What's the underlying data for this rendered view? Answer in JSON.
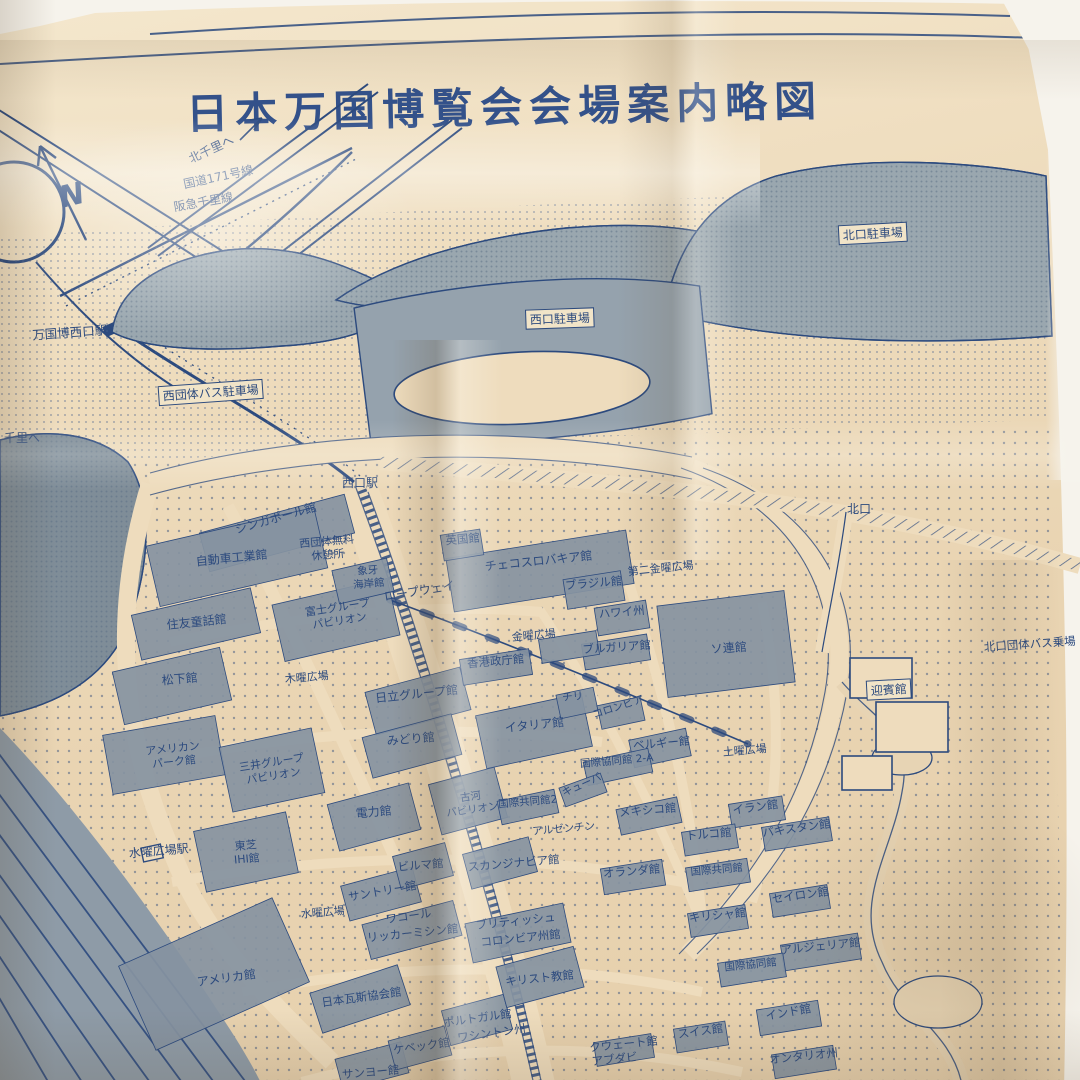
{
  "photo": {
    "title": "日本万国博覧会会場案内略図",
    "compass_label": "N"
  },
  "map": {
    "ink": "#2c4a7e",
    "fabric": "#eedcbd",
    "block": "#8593a1",
    "hill": "#9aa7af",
    "labels": [
      {
        "text": "北千里へ",
        "x": 213,
        "y": 153,
        "rot": -25,
        "size": 12
      },
      {
        "text": "国道171号線",
        "x": 219,
        "y": 181,
        "rot": -12,
        "size": 12
      },
      {
        "text": "阪急千里線",
        "x": 204,
        "y": 206,
        "rot": -10,
        "size": 12
      },
      {
        "text": "北口駐車場",
        "x": 873,
        "y": 238,
        "rot": -3,
        "size": 12,
        "boxed": true
      },
      {
        "text": "万国博西口駅",
        "x": 70,
        "y": 337,
        "rot": -4,
        "size": 12.5
      },
      {
        "text": "西口駐車場",
        "x": 560,
        "y": 323,
        "rot": -2,
        "size": 12,
        "boxed": true
      },
      {
        "text": "西団体バス駐車場",
        "x": 211,
        "y": 397,
        "rot": -4,
        "size": 12,
        "boxed": true
      },
      {
        "text": "千里へ",
        "x": 22,
        "y": 442,
        "rot": 0,
        "size": 12
      },
      {
        "text": "西口駅",
        "x": 360,
        "y": 487,
        "rot": 0,
        "size": 12
      },
      {
        "text": "北口",
        "x": 859,
        "y": 513,
        "rot": 0,
        "size": 12
      },
      {
        "text": "シンガポール館",
        "x": 277,
        "y": 522,
        "rot": -16,
        "size": 12
      },
      {
        "lines": [
          "西団体無料",
          "休憩所"
        ],
        "x": 327,
        "y": 545,
        "rot": -5,
        "size": 11
      },
      {
        "text": "自動車工業館",
        "x": 232,
        "y": 562,
        "rot": -6,
        "size": 12
      },
      {
        "text": "英国館",
        "x": 463,
        "y": 543,
        "rot": -5,
        "size": 11.5
      },
      {
        "text": "チェコスロバキア館",
        "x": 539,
        "y": 565,
        "rot": -6,
        "size": 12
      },
      {
        "text": "第二金曜広場",
        "x": 661,
        "y": 572,
        "rot": -6,
        "size": 11
      },
      {
        "text": "ブラジル館",
        "x": 594,
        "y": 587,
        "rot": -5,
        "size": 11.5
      },
      {
        "lines": [
          "象牙",
          "海岸館"
        ],
        "x": 368,
        "y": 574,
        "rot": -5,
        "size": 10.5
      },
      {
        "text": "ロープウェイ",
        "x": 420,
        "y": 595,
        "rot": -9,
        "size": 12
      },
      {
        "text": "ハワイ州",
        "x": 622,
        "y": 616,
        "rot": -5,
        "size": 11.5
      },
      {
        "lines": [
          "富士グループ",
          "パビリオン"
        ],
        "x": 338,
        "y": 611,
        "rot": -9,
        "size": 11
      },
      {
        "text": "住友童話館",
        "x": 197,
        "y": 626,
        "rot": -6,
        "size": 12
      },
      {
        "text": "金曜広場",
        "x": 534,
        "y": 639,
        "rot": -5,
        "size": 11
      },
      {
        "text": "ブルガリア館",
        "x": 617,
        "y": 651,
        "rot": -4,
        "size": 11.5
      },
      {
        "text": "ソ連館",
        "x": 729,
        "y": 652,
        "rot": -4,
        "size": 12
      },
      {
        "text": "北口団体バス乗場",
        "x": 1030,
        "y": 648,
        "rot": -4,
        "size": 11.5
      },
      {
        "text": "香港政庁館",
        "x": 496,
        "y": 665,
        "rot": -5,
        "size": 11.5
      },
      {
        "text": "松下館",
        "x": 180,
        "y": 683,
        "rot": -5,
        "size": 12
      },
      {
        "text": "木曜広場",
        "x": 307,
        "y": 681,
        "rot": -5,
        "size": 11
      },
      {
        "text": "迎賓館",
        "x": 889,
        "y": 694,
        "rot": -3,
        "size": 12,
        "boxed": true
      },
      {
        "text": "日立グループ館",
        "x": 417,
        "y": 698,
        "rot": -6,
        "size": 12
      },
      {
        "text": "チリ",
        "x": 573,
        "y": 700,
        "rot": -5,
        "size": 10.5
      },
      {
        "text": "コロンビア",
        "x": 619,
        "y": 710,
        "rot": -18,
        "size": 10.5
      },
      {
        "text": "イタリア館",
        "x": 535,
        "y": 729,
        "rot": -6,
        "size": 12
      },
      {
        "text": "ベルギー館",
        "x": 662,
        "y": 747,
        "rot": -5,
        "size": 11.5
      },
      {
        "text": "土曜広場",
        "x": 745,
        "y": 754,
        "rot": -5,
        "size": 11
      },
      {
        "lines": [
          "アメリカン",
          "パーク館"
        ],
        "x": 173,
        "y": 752,
        "rot": -6,
        "size": 11
      },
      {
        "text": "みどり館",
        "x": 411,
        "y": 743,
        "rot": -5,
        "size": 12
      },
      {
        "text": "国際協同館 2-A",
        "x": 617,
        "y": 764,
        "rot": -5,
        "size": 10.5
      },
      {
        "lines": [
          "三井グループ",
          "パビリオン"
        ],
        "x": 272,
        "y": 766,
        "rot": -9,
        "size": 11
      },
      {
        "text": "キューバ",
        "x": 583,
        "y": 788,
        "rot": -24,
        "size": 10.5
      },
      {
        "text": "国際共同館2",
        "x": 528,
        "y": 805,
        "rot": -5,
        "size": 10.5
      },
      {
        "text": "メキシコ館",
        "x": 648,
        "y": 814,
        "rot": -5,
        "size": 11.5
      },
      {
        "text": "イラン館",
        "x": 756,
        "y": 811,
        "rot": -8,
        "size": 11.5
      },
      {
        "text": "電力館",
        "x": 374,
        "y": 816,
        "rot": -5,
        "size": 12
      },
      {
        "lines": [
          "古河",
          "パビリオン"
        ],
        "x": 471,
        "y": 800,
        "rot": -8,
        "size": 10.5
      },
      {
        "text": "アルゼンチン",
        "x": 564,
        "y": 832,
        "rot": -5,
        "size": 10.5
      },
      {
        "text": "トルコ館",
        "x": 709,
        "y": 838,
        "rot": -5,
        "size": 11.5
      },
      {
        "text": "パキスタン館",
        "x": 797,
        "y": 832,
        "rot": -8,
        "size": 11.5
      },
      {
        "text": "水曜広場駅",
        "x": 159,
        "y": 855,
        "rot": -5,
        "size": 12
      },
      {
        "lines": [
          "東芝",
          "IHI館"
        ],
        "x": 246,
        "y": 849,
        "rot": -5,
        "size": 11
      },
      {
        "text": "ビルマ館",
        "x": 421,
        "y": 869,
        "rot": -5,
        "size": 11.5
      },
      {
        "text": "スカンジナビア館",
        "x": 514,
        "y": 867,
        "rot": -5,
        "size": 11.5
      },
      {
        "text": "オランダ館",
        "x": 632,
        "y": 875,
        "rot": -5,
        "size": 11.5
      },
      {
        "text": "国際共同館",
        "x": 717,
        "y": 873,
        "rot": -5,
        "size": 10.5
      },
      {
        "text": "セイロン館",
        "x": 801,
        "y": 899,
        "rot": -8,
        "size": 11.5
      },
      {
        "text": "サントリー館",
        "x": 383,
        "y": 895,
        "rot": -10,
        "size": 11.5
      },
      {
        "text": "水曜広場",
        "x": 323,
        "y": 916,
        "rot": -5,
        "size": 11
      },
      {
        "text": "ワコール",
        "x": 409,
        "y": 920,
        "rot": -8,
        "size": 11.5
      },
      {
        "text": "リッカーミシン館",
        "x": 413,
        "y": 937,
        "rot": -6,
        "size": 11.5
      },
      {
        "text": "ブリティッシュ",
        "x": 516,
        "y": 925,
        "rot": -6,
        "size": 11.5
      },
      {
        "text": "コロンビア州館",
        "x": 521,
        "y": 942,
        "rot": -6,
        "size": 11.5
      },
      {
        "text": "キリシャ館",
        "x": 718,
        "y": 919,
        "rot": -6,
        "size": 11.5
      },
      {
        "text": "アルジェリア館",
        "x": 821,
        "y": 950,
        "rot": -6,
        "size": 11.5
      },
      {
        "text": "アメリカ館",
        "x": 227,
        "y": 982,
        "rot": -8,
        "size": 12
      },
      {
        "text": "国際協同館",
        "x": 751,
        "y": 968,
        "rot": -6,
        "size": 10.5
      },
      {
        "text": "キリスト教館",
        "x": 540,
        "y": 982,
        "rot": -6,
        "size": 11.5
      },
      {
        "text": "日本瓦斯協会館",
        "x": 362,
        "y": 1001,
        "rot": -8,
        "size": 11.5
      },
      {
        "text": "ポルトガル館",
        "x": 478,
        "y": 1022,
        "rot": -8,
        "size": 11.5
      },
      {
        "text": "ワシントン州",
        "x": 492,
        "y": 1037,
        "rot": -8,
        "size": 11.5
      },
      {
        "text": "ケベック館",
        "x": 422,
        "y": 1050,
        "rot": -8,
        "size": 11.5
      },
      {
        "text": "インド館",
        "x": 789,
        "y": 1016,
        "rot": -10,
        "size": 11.5
      },
      {
        "text": "スイス館",
        "x": 701,
        "y": 1035,
        "rot": -8,
        "size": 11.5
      },
      {
        "text": "クウェート館",
        "x": 624,
        "y": 1048,
        "rot": -6,
        "size": 11.5
      },
      {
        "text": "アブダビ",
        "x": 615,
        "y": 1063,
        "rot": -6,
        "size": 11.5
      },
      {
        "text": "オンタリオ州",
        "x": 804,
        "y": 1060,
        "rot": -6,
        "size": 11.5
      },
      {
        "text": "サンヨー館",
        "x": 371,
        "y": 1076,
        "rot": -5,
        "size": 11.5
      }
    ]
  }
}
